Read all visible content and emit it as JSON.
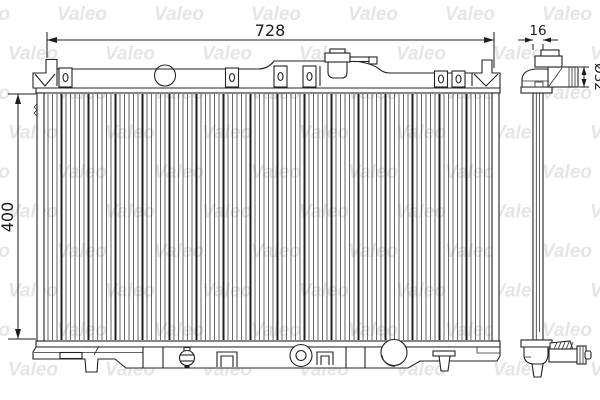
{
  "title": "Valeo radiator technical drawing",
  "watermark": {
    "text": "Valeo"
  },
  "views": {
    "front": {
      "name": "front-view"
    },
    "side": {
      "name": "side-view"
    }
  },
  "dimensions": {
    "overall_width": "728",
    "core_height": "400",
    "core_thickness": "16",
    "pipe_diameter": "Ø32"
  },
  "colors": {
    "line": "#232323",
    "dim_line": "#1d1d1d",
    "watermark": "#cdcdcd",
    "background": "#ffffff",
    "fin": "#4a4a4a",
    "fin_dark": "#1f1f1f"
  }
}
